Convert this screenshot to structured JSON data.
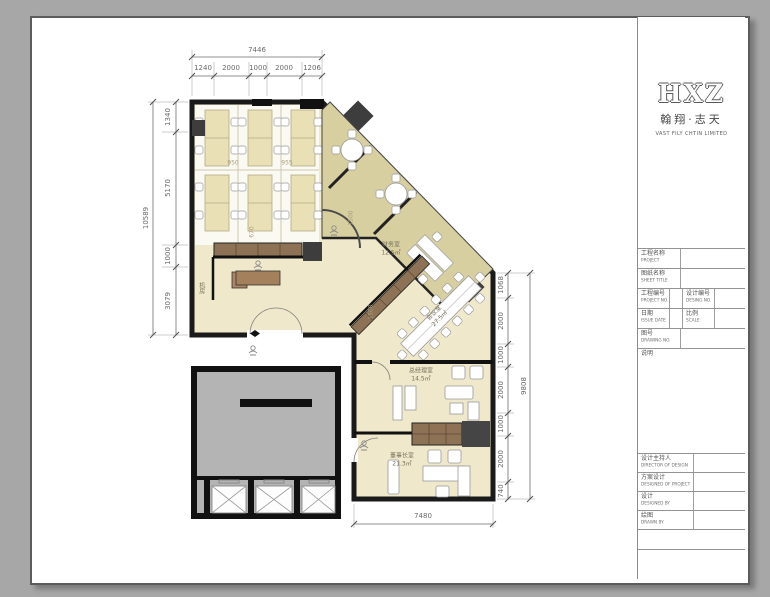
{
  "title_block": {
    "logo": {
      "monogram": "HXZ",
      "cn": "翰翔·志天",
      "en": "VAST FILY CHTIN LIMITED"
    },
    "info_rows": [
      {
        "cn": "工程名称",
        "en": "PROJECT"
      },
      {
        "cn": "图纸名称",
        "en": "SHEET TITLE"
      },
      {
        "cn": "工程编号",
        "en": "PROJECT NO.",
        "cn2": "设计编号",
        "en2": "DESING NO."
      },
      {
        "cn": "日期",
        "en": "ISSUE DATE",
        "cn2": "比例",
        "en2": "SCALE"
      },
      {
        "cn": "图号",
        "en": "DRAWING NO."
      },
      {
        "cn": "说明",
        "en": ""
      }
    ],
    "sign_rows": [
      {
        "cn": "设计主持人",
        "en": "DIRECTOR OF DESIGN"
      },
      {
        "cn": "方案设计",
        "en": "DESIGNED OF PROJECT"
      },
      {
        "cn": "设计",
        "en": "DESIGNED BY"
      },
      {
        "cn": "绘图",
        "en": "DRAWN BY"
      }
    ]
  },
  "plan": {
    "rooms": {
      "finance": {
        "name": "财务室",
        "area": "12.5㎡"
      },
      "meeting": {
        "name": "会议室",
        "area": "27.5㎡"
      },
      "gm": {
        "name": "总经理室",
        "area": "14.5㎡"
      },
      "chairman": {
        "name": "董事长室",
        "area": "21.3㎡"
      },
      "machine": {
        "name": "机房",
        "area": ""
      }
    },
    "dims": {
      "top_total": "7446",
      "top_segments": [
        "1240",
        "2000",
        "1000",
        "2000",
        "1206"
      ],
      "left_total": "10589",
      "left_segments": [
        "1340",
        "5170",
        "1000",
        "3079"
      ],
      "right_total": "9808",
      "right_segments": [
        "1068",
        "2000",
        "1000",
        "2000",
        "1000",
        "2000",
        "740"
      ],
      "bottom_total": "7480",
      "inner": [
        "950",
        "955",
        "670",
        "1500",
        "1500"
      ]
    },
    "colors": {
      "wall": "#1a1a1a",
      "floor": "#efe8cb",
      "band": "#d8cfa0",
      "cabinet": "#8d7255",
      "core": "#b4b4b4"
    }
  }
}
